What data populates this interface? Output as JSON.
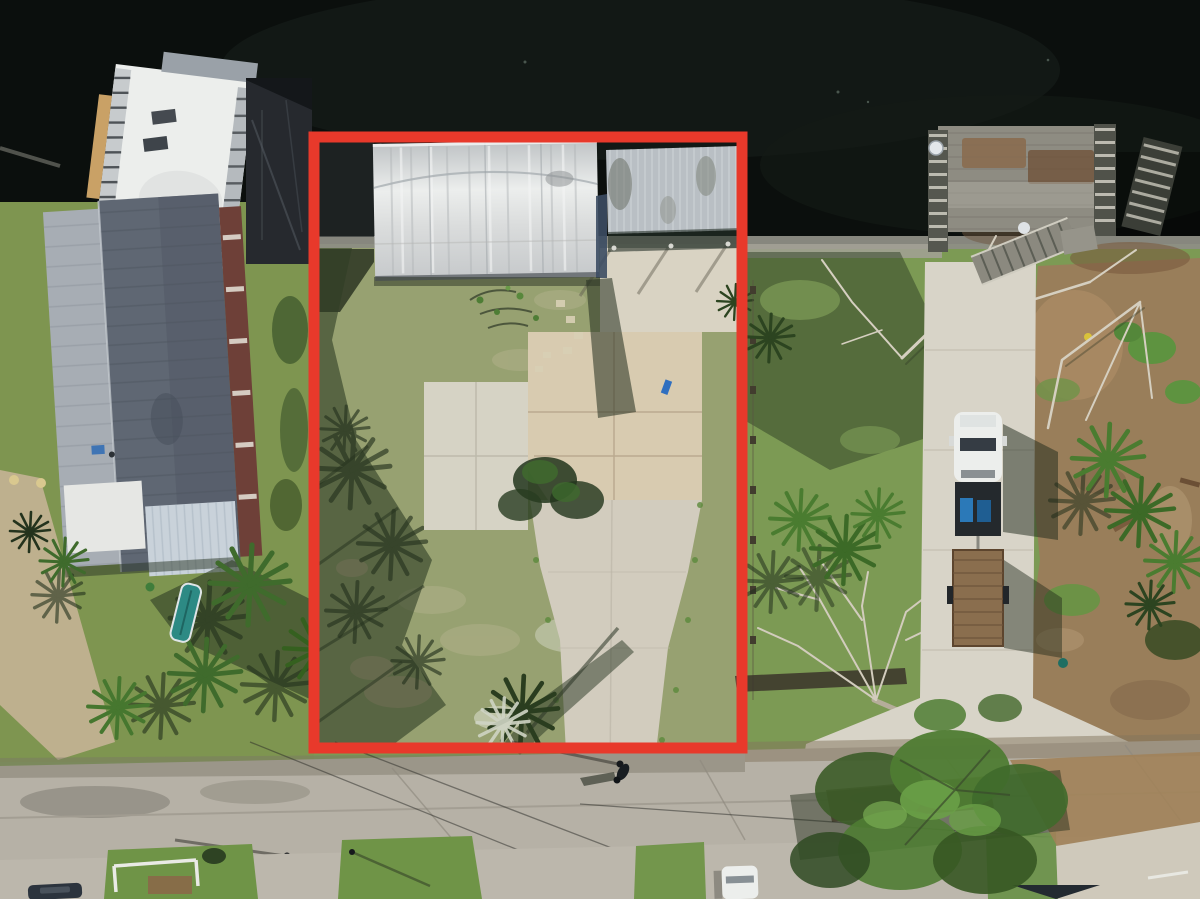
{
  "meta": {
    "kind": "aerial-drone-photograph",
    "subject": "waterfront-residential-lot-with-red-property-boundary-outline",
    "image_width": 1200,
    "image_height": 899
  },
  "annotation": {
    "name": "property-boundary-outline",
    "shape": "rectangle",
    "x": 314,
    "y": 137,
    "width": 428,
    "height": 611,
    "stroke_width": 11,
    "color": "#e8392b"
  },
  "colors": {
    "red": "#e8392b",
    "water": "#0b0f0d",
    "seawall": "#8e8e85",
    "grass_left": "#7e9550",
    "grass_lot": "#97a171",
    "grass_right": "#7c9a54",
    "grass_shadow": "#2e3d24",
    "lawn_bottom": "#6f9447",
    "concrete": "#d2ccbe",
    "concrete_bright": "#d8d4c8",
    "slab": "#d8cbb0",
    "road": "#b6b1a6",
    "dirt": "#9a7d5b",
    "roof_dark": "#5f6773",
    "roof_light": "#a7adb4",
    "porch": "#c9d2da",
    "white": "#eceeec",
    "carport": "#b9bfc4",
    "wood": "#8e8c82",
    "trailer": "#8a6e4e",
    "truck_blue": "#2b79b8",
    "branch": "#d2ccbd",
    "palm": "#3f6b2c",
    "palm_dark": "#24331d",
    "canopy": "#4f7c33",
    "shadow": "#1f2a18"
  },
  "scene": {
    "objects": [
      "water-canal",
      "seawall",
      "outlined-vacant-lot",
      "metal-barn-building",
      "carport-roof",
      "concrete-house-slab",
      "concrete-driveway",
      "left-house-metal-roof",
      "rooftop-deck-building",
      "damaged-dock-deck",
      "dock-stairs",
      "satellite-dish",
      "pickup-truck",
      "flatbed-trailer",
      "fallen-bare-tree",
      "palm-trees",
      "dirt-yard",
      "street-road",
      "utility-pole",
      "pedestrian",
      "white-car",
      "dark-car",
      "bottom-lawns",
      "leafy-tree-canopy"
    ]
  }
}
